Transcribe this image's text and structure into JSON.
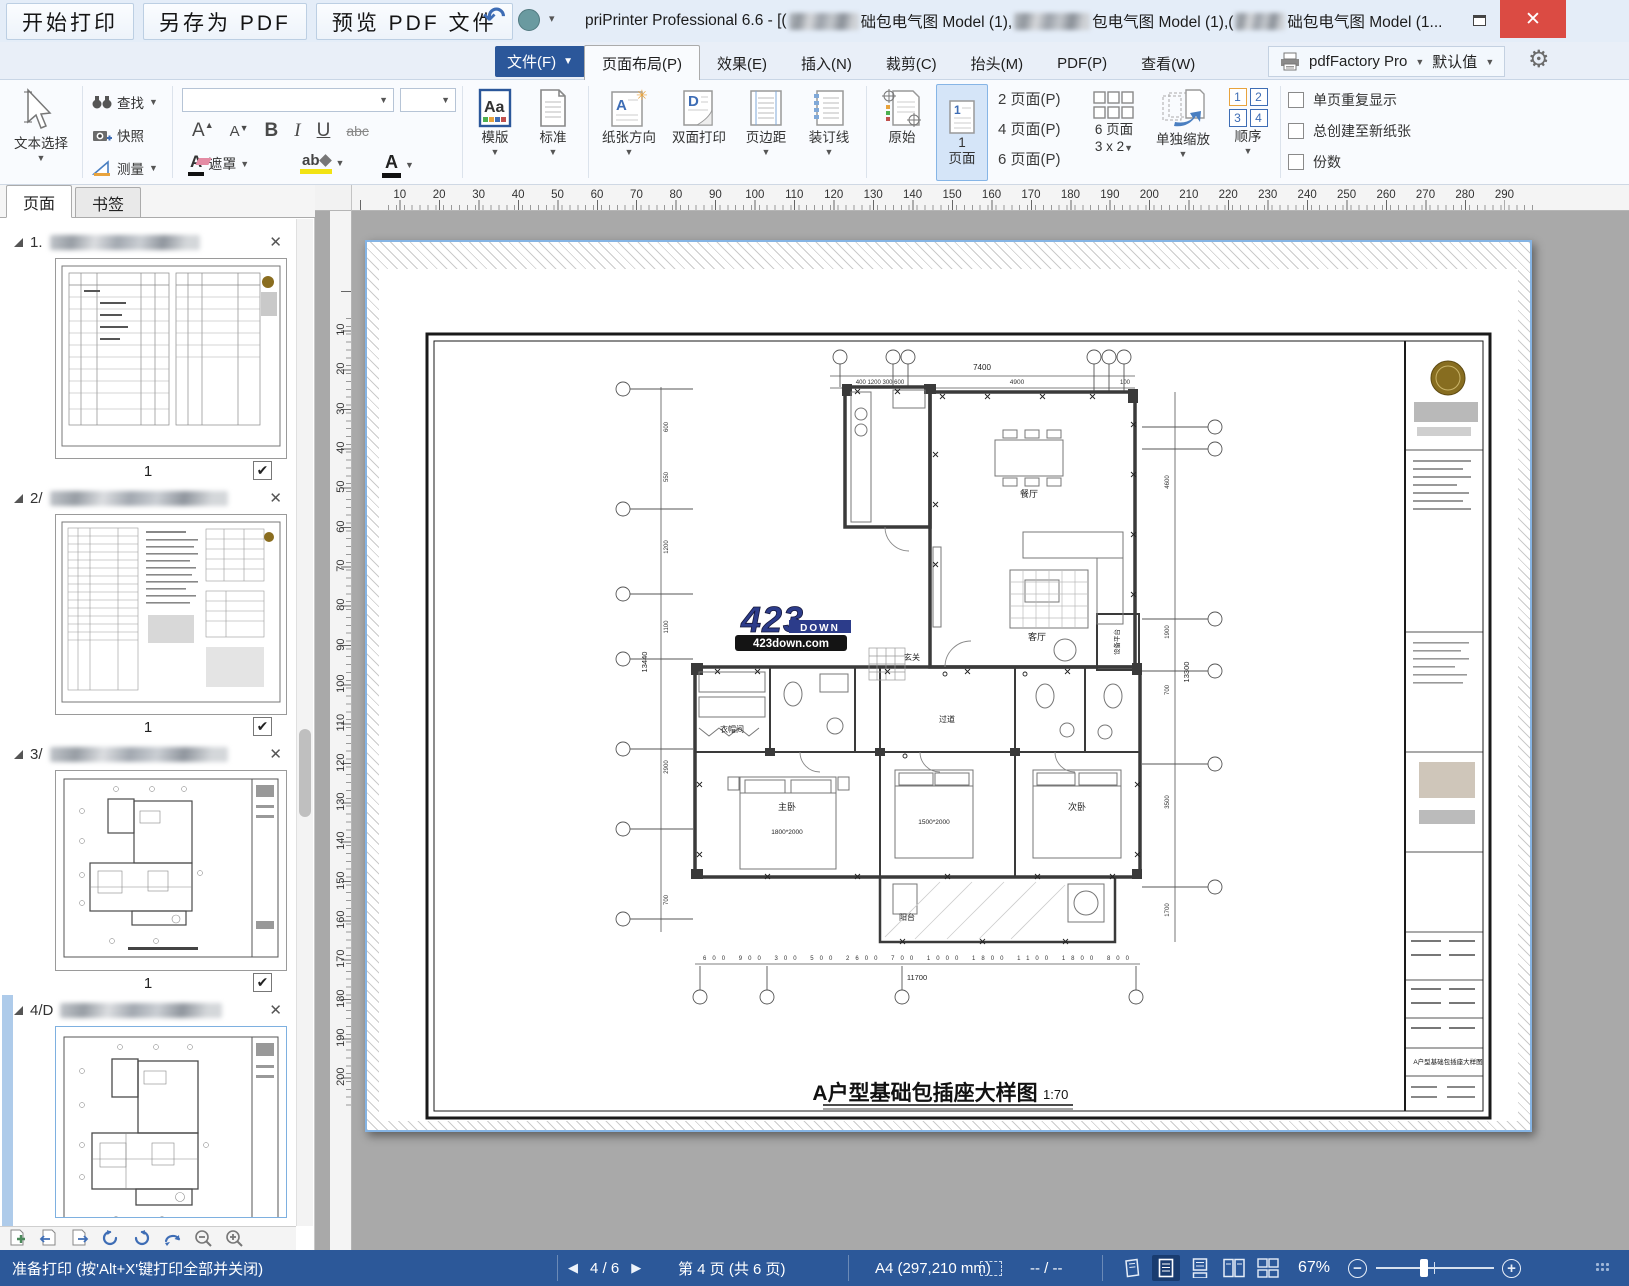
{
  "titlebar": {
    "quick_buttons": [
      "开始打印",
      "另存为 PDF",
      "预览 PDF 文件"
    ],
    "title_seg0": "priPrinter Professional 6.6 - [(",
    "title_seg1": "础包电气图 Model (1),",
    "title_seg2": "包电气图 Model (1),(",
    "title_seg3": "础包电气图 Model (1...",
    "close_glyph": "✕"
  },
  "menubar": {
    "file_label": "文件(F)",
    "tabs": [
      {
        "label": "页面布局(P)",
        "active": true
      },
      {
        "label": "效果(E)"
      },
      {
        "label": "插入(N)"
      },
      {
        "label": "裁剪(C)"
      },
      {
        "label": "抬头(M)"
      },
      {
        "label": "PDF(P)"
      },
      {
        "label": "查看(W)"
      }
    ],
    "printer_name": "pdfFactory Pro",
    "printer_profile": "默认值"
  },
  "ribbon": {
    "text_select": "文本选择",
    "find": "查找",
    "snapshot": "快照",
    "measure": "测量",
    "bold": "B",
    "italic": "I",
    "underline": "U",
    "strike": "abc",
    "mask": "遮罩",
    "template": "模版",
    "standard": "标准",
    "orientation": "纸张方向",
    "duplex": "双面打印",
    "margins": "页边距",
    "gutter": "装订线",
    "original": "原始",
    "one_num": "1",
    "one_label": "页面",
    "pages2": "2 页面(P)",
    "pages4": "4 页面(P)",
    "pages6": "6 页面(P)",
    "pages6_line1": "6 页面",
    "pages6_line2": "3 x 2",
    "scale_individual": "单独缩放",
    "order": "顺序",
    "order_nums": [
      "1",
      "2",
      "3",
      "4"
    ],
    "checkboxes": [
      "单页重复显示",
      "总创建至新纸张",
      "份数"
    ]
  },
  "sidebar": {
    "tabs": [
      {
        "label": "页面",
        "active": true
      },
      {
        "label": "书签"
      }
    ],
    "items": [
      {
        "index": "1."
      },
      {
        "index": "2/"
      },
      {
        "index": "3/"
      },
      {
        "index": "4/D"
      }
    ],
    "page_no": "1",
    "check_glyph": "✔"
  },
  "canvas": {
    "h_ruler_start": 10,
    "h_ruler_end": 290,
    "v_ruler_start": 10,
    "v_ruler_end": 200,
    "drawing": {
      "title": "A户型基础包插座大样图",
      "scale": "1:70",
      "watermark_num": "423",
      "watermark_word": "DOWN",
      "watermark_url": "423down.com",
      "rooms": {
        "dining": "餐厅",
        "living": "客厅",
        "master": "主卧",
        "second": "次卧",
        "balcony": "阳台",
        "corridor": "过道",
        "cloak": "衣帽间",
        "foyer": "玄关",
        "equipment": "设备平台"
      },
      "dims": {
        "top_total": "7400",
        "top_segs": "400  1200  300  600",
        "top_mid": "4900",
        "top_end": "100",
        "bottom_total": "11700",
        "bottom_segs": "600  900  300  500  2600  700  1000  1800  1100  1800  800",
        "left_total": "13440",
        "right_total": "13300",
        "right_segs": [
          "4600",
          "1900",
          "700",
          "3500",
          "1700"
        ],
        "left_segs": [
          "600",
          "550",
          "1200",
          "1100",
          "2900",
          "700"
        ],
        "bed1": "1800*2000",
        "bed2": "1500*2000"
      }
    }
  },
  "statusbar": {
    "status": "准备打印 (按'Alt+X'键打印全部并关闭)",
    "nav_current": "4 / 6",
    "page_info": "第 4 页 (共 6 页)",
    "paper": "A4 (297,210 mm)",
    "selection": "-- / --",
    "zoom": "67%"
  }
}
